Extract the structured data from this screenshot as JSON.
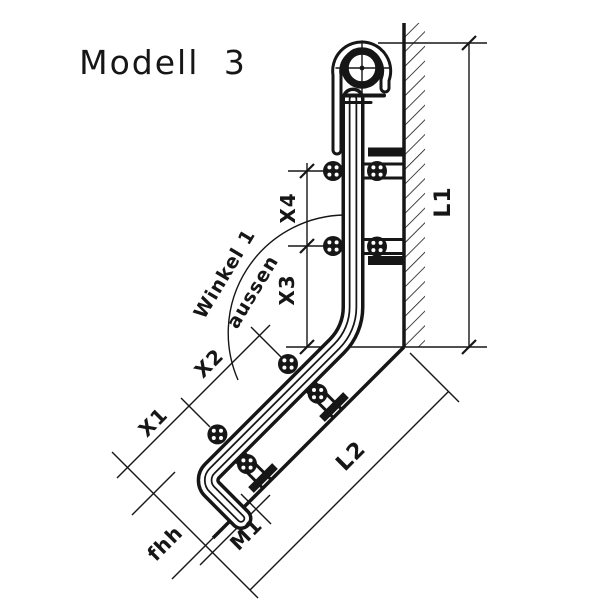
{
  "title": "Modell 3",
  "colors": {
    "ink": "#161616",
    "paper": "#ffffff"
  },
  "labels": {
    "l1": "L1",
    "x4": "X4",
    "x3": "X3",
    "winkel_line1": "Winkel 1",
    "winkel_line2": "aussen",
    "x2": "X2",
    "x1": "X1",
    "l2": "L2",
    "m1": "M1",
    "fhh": "fhh"
  }
}
